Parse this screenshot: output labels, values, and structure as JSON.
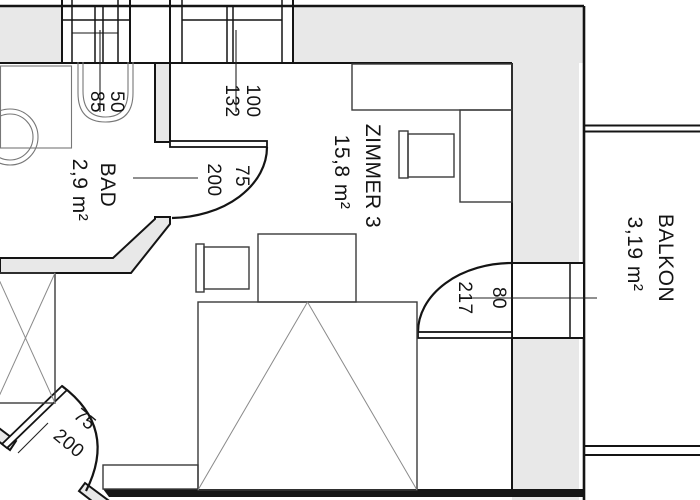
{
  "rooms": {
    "bad": {
      "name": "BAD",
      "area": "2,9 m²"
    },
    "zimmer3": {
      "name": "ZIMMER 3",
      "area": "15,8 m²"
    },
    "balkon": {
      "name": "BALKON",
      "area": "3,19 m²"
    }
  },
  "dimensions": {
    "bad_window": {
      "width": "50",
      "height": "85"
    },
    "zimmer_window": {
      "width": "100",
      "height": "132"
    },
    "bad_door": {
      "width": "75",
      "height": "200"
    },
    "balcony_door": {
      "width": "80",
      "height": "217"
    },
    "entry_door": {
      "width": "75",
      "height": "200"
    }
  },
  "colors": {
    "wall_fill": "#e8e8e8",
    "line": "#141414",
    "fixture": "#777777",
    "furniture": "#3a3a3a",
    "bed_diag": "#8a8a8a",
    "bg": "#ffffff"
  }
}
